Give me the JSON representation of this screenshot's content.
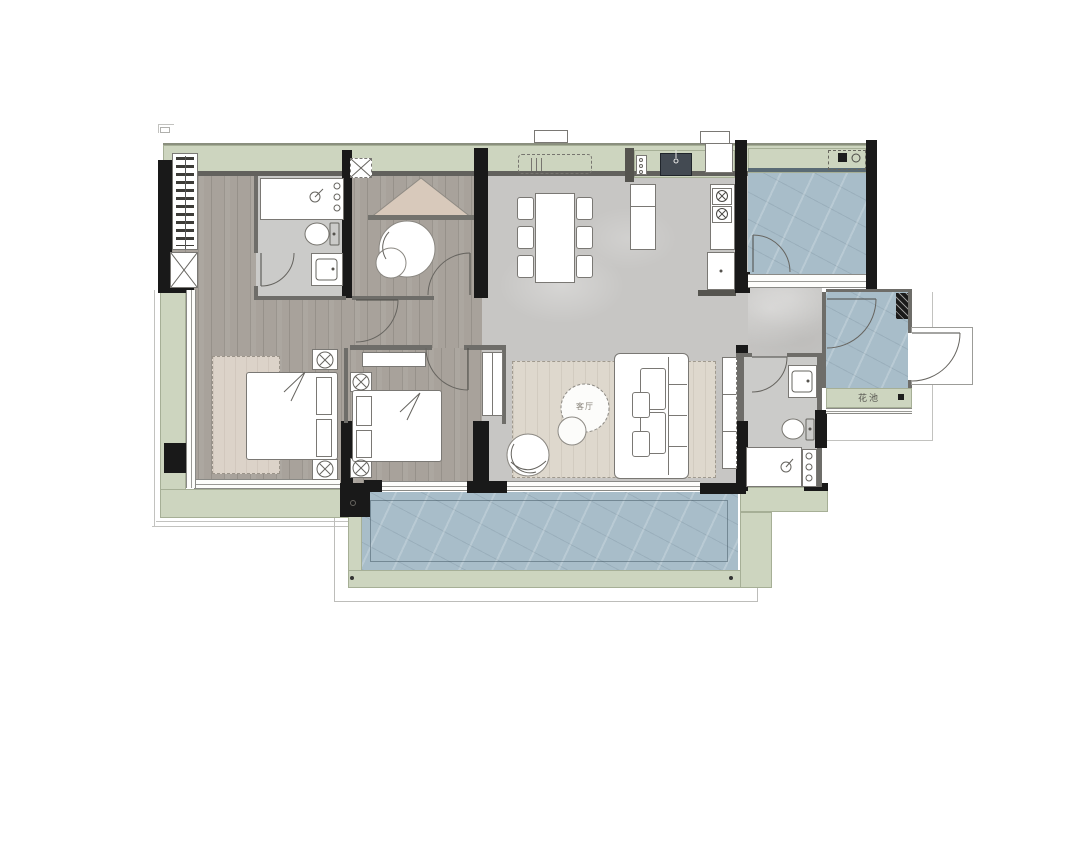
{
  "labels": {
    "living_room": "客厅",
    "flower_bed": "花池"
  },
  "palette": {
    "background": "#ffffff",
    "wall_black": "#191919",
    "wood_floor": "#a8a29b",
    "stone_tile": "#c7c6c4",
    "bathroom_tile": "#cbcbc9",
    "balcony_tile": "#a8bdc9",
    "planter_green": "#cdd5bf",
    "bedroom_rug": "#dcd3c9",
    "living_rug": "#ded8cd",
    "play_tent": "#d8c9bb",
    "furniture_outline": "#7a7874"
  },
  "icons": {
    "shaft": "box-with-x",
    "stove_burner": "circle-with-x",
    "washing_machine": "square-plus-circle",
    "shower_head": "circle-with-arm",
    "table_lamp": "circle-with-cross",
    "door_swing": "quarter-arc",
    "wardrobe_hangers": "hatched-bars"
  }
}
